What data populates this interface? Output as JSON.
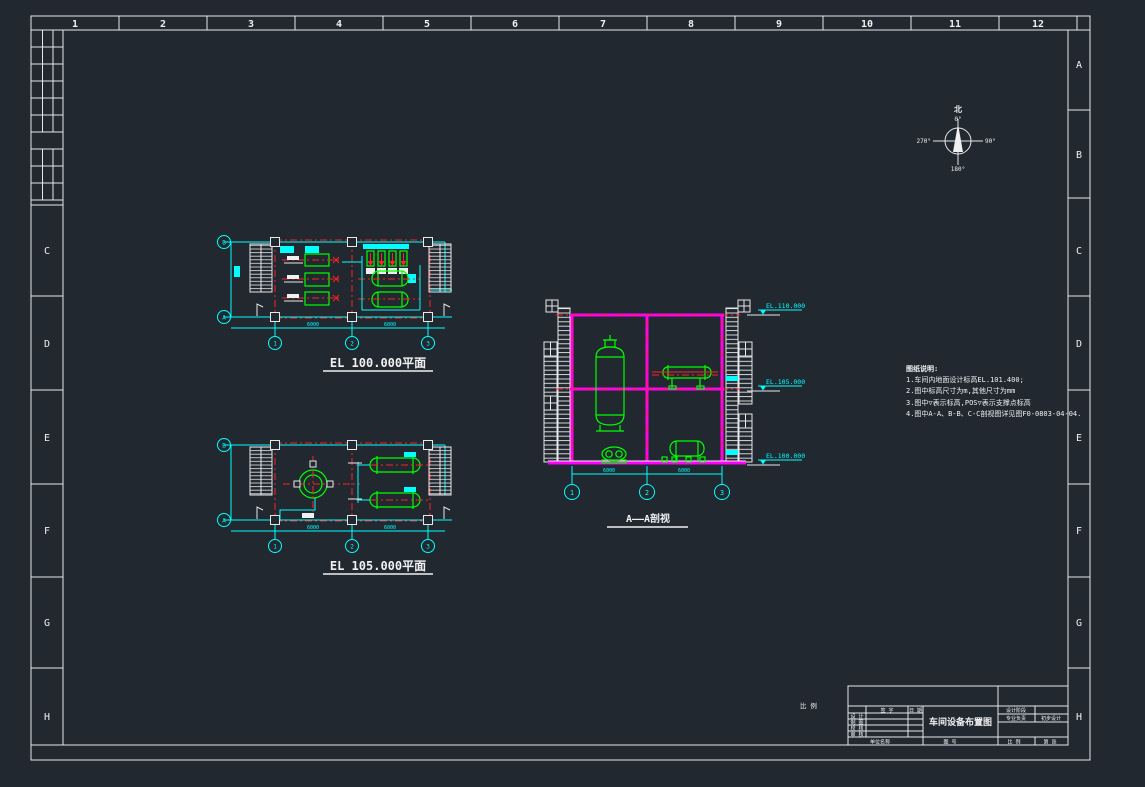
{
  "meta": {
    "bg": "#212830",
    "accent_cyan": "#00ffff",
    "accent_green": "#00ff00",
    "accent_red": "#ff2222",
    "accent_magenta": "#ff00ff",
    "line_white": "#f0f0f0"
  },
  "border": {
    "cols": [
      "1",
      "2",
      "3",
      "4",
      "5",
      "6",
      "7",
      "8",
      "9",
      "10",
      "11",
      "12"
    ],
    "rows_left": [
      "C",
      "D",
      "E",
      "F",
      "G",
      "H"
    ],
    "rows_right": [
      "A",
      "B",
      "C",
      "D",
      "E",
      "F",
      "G",
      "H"
    ]
  },
  "compass": {
    "north_label": "北",
    "deg_top": "0°",
    "deg_right": "90°",
    "deg_bottom": "180°",
    "deg_left": "270°"
  },
  "plan_el100": {
    "label": "EL 100.000平面",
    "axis_letters": [
      "B",
      "A"
    ],
    "axis_numbers": [
      "1",
      "2",
      "3"
    ],
    "dims": [
      "6000",
      "6000"
    ]
  },
  "plan_el105": {
    "label": "EL 105.000平面",
    "axis_letters": [
      "B",
      "A"
    ],
    "axis_numbers": [
      "1",
      "2",
      "3"
    ],
    "dims": [
      "6000",
      "6000"
    ]
  },
  "section": {
    "label": "A——A剖视",
    "axis_numbers": [
      "1",
      "2",
      "3"
    ],
    "dims": [
      "6000",
      "6000"
    ],
    "elevations": [
      "EL.110.000",
      "EL.105.000",
      "EL.100.000"
    ]
  },
  "notes": {
    "title": "图纸说明:",
    "items": [
      "1.车间内地面设计标高EL.101.400;",
      "2.图中标高尺寸为m,其他尺寸为mm",
      "3.图中▽表示标高,POS▽表示支撑点标高",
      "4.图中A-A、B-B、C-C剖视图详见图F0-0803-04-04."
    ]
  },
  "scale_note": "比 例",
  "title_block": {
    "sign_header": "签 字",
    "date_header": "日 期",
    "row_labels": [
      "设 计",
      "制 图",
      "校 核",
      "审 核"
    ],
    "drawing_title": "车间设备布置图",
    "stage_label": "设计阶段",
    "discipline_label": "专业负责",
    "stage_value": "初步设计",
    "bottom_cells": [
      "单位名称",
      "图 号",
      "比 例",
      "第 张"
    ]
  }
}
